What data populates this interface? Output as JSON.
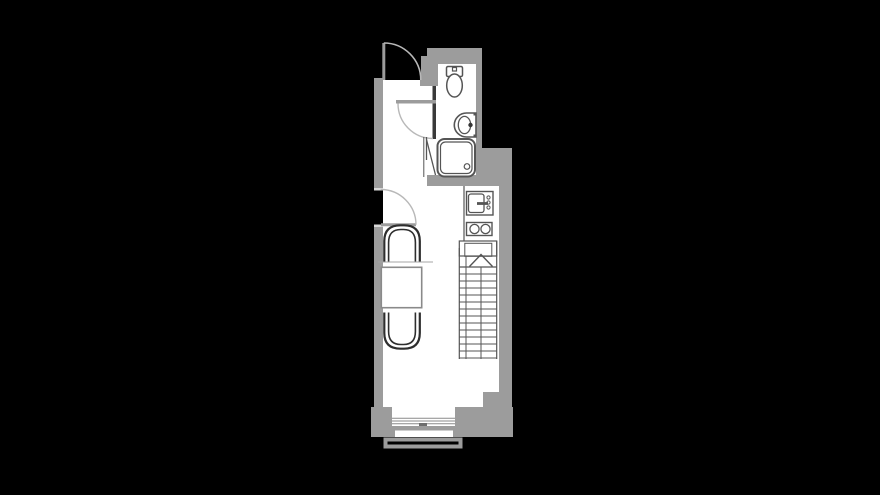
{
  "meta": {
    "type": "architectural-floor-plan",
    "visible_text": []
  },
  "colors": {
    "background": "#000000",
    "wall": "#9c9c9c",
    "dark_wall": "#3a3a3a",
    "floor": "#ffffff",
    "fixture_line": "#555555",
    "furniture_line": "#2e2e2e",
    "door_arc": "#b8b8b8",
    "stair_line": "#555555",
    "table_line": "#8a8a8a",
    "glazing_line": "#8a8a8a",
    "jamb_tick": "#d9d9d9"
  },
  "plan": {
    "doors": [
      {
        "name": "entrance-door",
        "swing": "outward",
        "location": "top-left"
      },
      {
        "name": "bathroom-door",
        "swing": "inward",
        "location": "hall-to-bathroom"
      },
      {
        "name": "living-room-door",
        "swing": "inward",
        "location": "left-wall"
      }
    ],
    "fixtures": [
      {
        "name": "toilet",
        "location": "bathroom-top"
      },
      {
        "name": "washbasin",
        "location": "bathroom-right-wall",
        "faucet_dots": 1
      },
      {
        "name": "shower-tray",
        "location": "bathroom-bottom",
        "drain": 1
      },
      {
        "name": "kitchen-sink",
        "location": "kitchen-strip",
        "knobs": 3
      },
      {
        "name": "cooktop",
        "location": "kitchen-strip",
        "burners": 2
      }
    ],
    "stairs": {
      "direction": "up",
      "treads": 13,
      "arrow": "chevron-up"
    },
    "furniture": [
      {
        "name": "armchair-upper",
        "facing": "down"
      },
      {
        "name": "dining-table",
        "shape": "square"
      },
      {
        "name": "armchair-lower",
        "facing": "up"
      }
    ],
    "openings": [
      {
        "name": "window",
        "location": "bottom-wall",
        "glazing_lines": 3
      },
      {
        "name": "balcony-railing",
        "location": "below-bottom-wall"
      }
    ]
  }
}
